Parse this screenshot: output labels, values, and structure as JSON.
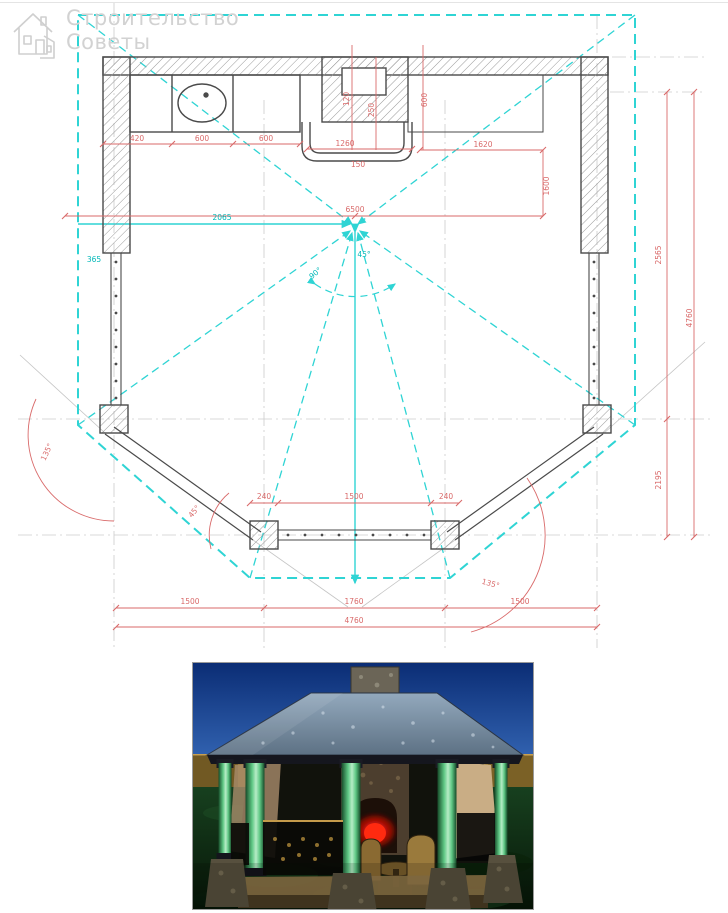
{
  "watermark": {
    "line1": "Строительство",
    "line2": "Советы"
  },
  "drawing": {
    "title": "Чертёж беседки — план с размерами",
    "colors": {
      "walls": "#4a4a4a",
      "dimension_red": "#d96a6a",
      "dimension_cyan": "#00b8b8",
      "roof_outline": "#2fd4d4",
      "grid": "#c9c9c9"
    },
    "dimension_labels": [
      {
        "text": "420",
        "x": 137,
        "y": 141
      },
      {
        "text": "600",
        "x": 202,
        "y": 141
      },
      {
        "text": "600",
        "x": 266,
        "y": 141
      },
      {
        "text": "1260",
        "x": 345,
        "y": 146
      },
      {
        "text": "150",
        "x": 358,
        "y": 167
      },
      {
        "text": "1620",
        "x": 483,
        "y": 147
      },
      {
        "text": "1600",
        "x": 549,
        "y": 186,
        "rotate": -90
      },
      {
        "text": "120",
        "x": 349,
        "y": 99,
        "rotate": -90
      },
      {
        "text": "250",
        "x": 374,
        "y": 110,
        "rotate": -90
      },
      {
        "text": "600",
        "x": 427,
        "y": 100,
        "rotate": -90
      },
      {
        "text": "6500",
        "x": 355,
        "y": 212
      },
      {
        "text": "2065",
        "x": 222,
        "y": 220,
        "color": "cyan"
      },
      {
        "text": "365",
        "x": 94,
        "y": 262,
        "color": "cyan"
      },
      {
        "text": "45°",
        "x": 364,
        "y": 257,
        "color": "cyan"
      },
      {
        "text": "90°",
        "x": 317,
        "y": 275,
        "color": "cyan",
        "rotate": -40
      },
      {
        "text": "2565",
        "x": 661,
        "y": 255,
        "rotate": -90
      },
      {
        "text": "2195",
        "x": 661,
        "y": 480,
        "rotate": -90
      },
      {
        "text": "4760",
        "x": 692,
        "y": 318,
        "rotate": -90
      },
      {
        "text": "240",
        "x": 264,
        "y": 499
      },
      {
        "text": "1500",
        "x": 354,
        "y": 499
      },
      {
        "text": "240",
        "x": 446,
        "y": 499
      },
      {
        "text": "45°",
        "x": 196,
        "y": 513,
        "rotate": -50
      },
      {
        "text": "135°",
        "x": 49,
        "y": 453,
        "rotate": -65
      },
      {
        "text": "135°",
        "x": 490,
        "y": 586,
        "rotate": 15
      },
      {
        "text": "1500",
        "x": 190,
        "y": 604
      },
      {
        "text": "1760",
        "x": 354,
        "y": 604
      },
      {
        "text": "1500",
        "x": 520,
        "y": 604
      },
      {
        "text": "4760",
        "x": 354,
        "y": 623
      }
    ]
  },
  "photo": {
    "caption": "3D визуализация беседки с камином",
    "palette": {
      "sky_top": "#0b2d75",
      "sky_bottom": "#3e74c4",
      "fence": "#97772f",
      "ground": "#123318",
      "roof": "#7c93a8",
      "column": "#5fc885",
      "stone": "#57503e",
      "fire": "#e01010"
    }
  }
}
